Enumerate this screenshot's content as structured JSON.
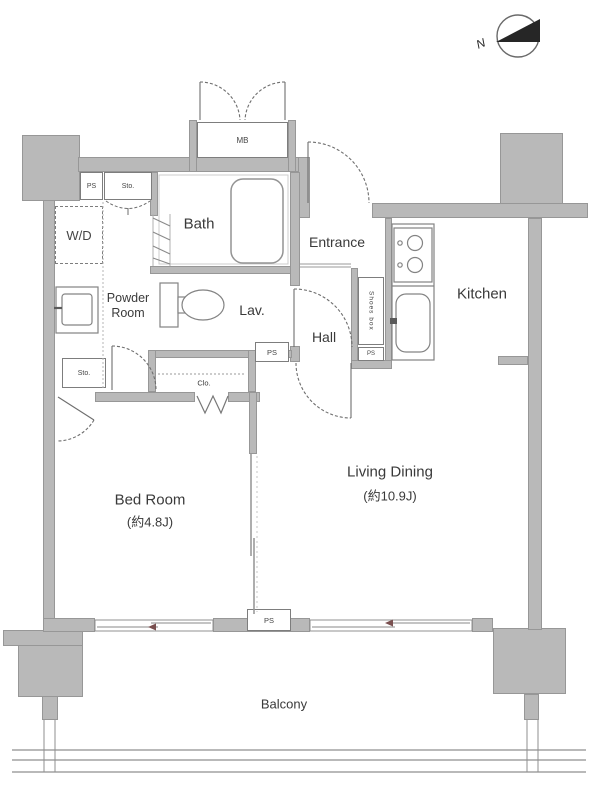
{
  "compass": {
    "north_label": "N"
  },
  "rooms": {
    "bath": {
      "label": "Bath"
    },
    "entrance": {
      "label": "Entrance"
    },
    "kitchen": {
      "label": "Kitchen"
    },
    "lav": {
      "label": "Lav."
    },
    "hall": {
      "label": "Hall"
    },
    "washer_dryer": {
      "label": "W/D"
    },
    "powder_room": {
      "label": "Powder Room"
    },
    "bed_room": {
      "label": "Bed Room",
      "size": "(約4.8J)"
    },
    "living_dining": {
      "label": "Living Dining",
      "size": "(約10.9J)"
    },
    "balcony": {
      "label": "Balcony"
    }
  },
  "labels": {
    "meter_box": "MB",
    "pipe_space": "PS",
    "storage": "Sto.",
    "closet": "Clo.",
    "shoes_box": "Shoes box"
  },
  "colors": {
    "wall_fill": "#b9b9b9",
    "wall_edge": "#979797",
    "fixture_line": "#7d7d7d",
    "door_arc": "#6e6e6e",
    "text": "#3a3a3a",
    "compass_fill": "#262626",
    "window_arrow": "#7a5050"
  }
}
